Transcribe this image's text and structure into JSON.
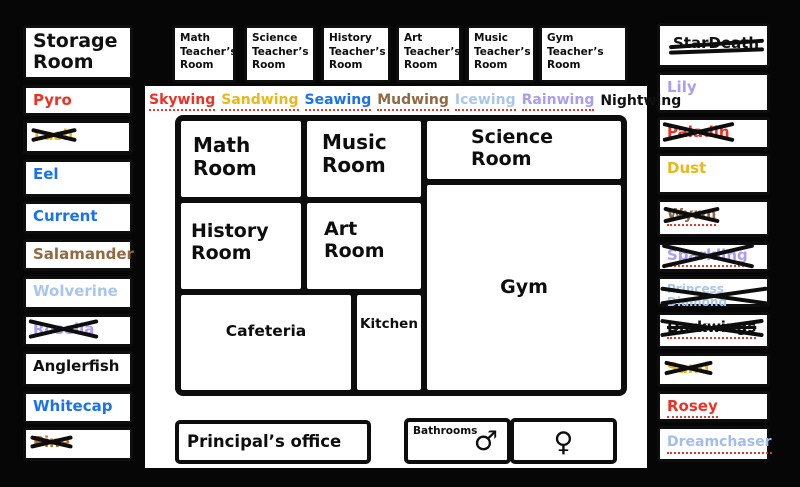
{
  "colors": {
    "skywing_red": "#ed3124",
    "sandwing_gold": "#eab818",
    "seawing_blue": "#1b72ee",
    "mudwing_brown": "#8f6a43",
    "icewing_pale_blue": "#a8c6ee",
    "rainwing_lavender": "#a99df5",
    "nightwing_black": "#101010"
  },
  "left_column": {
    "items": [
      {
        "label": "Storage Room",
        "color": "#101010",
        "status": "active"
      },
      {
        "label": "Pyro",
        "color": "#ed3124",
        "status": "active"
      },
      {
        "label": "Lash",
        "color": "#eab818",
        "status": "crossed-out"
      },
      {
        "label": "Eel",
        "color": "#1b72ee",
        "status": "active"
      },
      {
        "label": "Current",
        "color": "#1b72ee",
        "status": "active"
      },
      {
        "label": "Salamander",
        "color": "#8f6a43",
        "status": "active"
      },
      {
        "label": "Wolverine",
        "color": "#a8c6ee",
        "status": "active"
      },
      {
        "label": "Rosella",
        "color": "#a99df5",
        "status": "crossed-out"
      },
      {
        "label": "Anglerfish",
        "color": "#101010",
        "status": "active"
      },
      {
        "label": "Whitecap",
        "color": "#1b72ee",
        "status": "active"
      },
      {
        "label": "Pine",
        "color": "#b4762e",
        "status": "crossed-out"
      }
    ]
  },
  "right_column": {
    "items": [
      {
        "label": "StarDeath",
        "color": "#101010",
        "status": "struck-through"
      },
      {
        "label": "Lily",
        "color": "#a99df5",
        "status": "active"
      },
      {
        "label": "Paladin",
        "color": "#ed3124",
        "status": "crossed-out"
      },
      {
        "label": "Dust",
        "color": "#eab818",
        "status": "active"
      },
      {
        "label": "Wyrm",
        "color": "#8f6a43",
        "status": "crossed-out"
      },
      {
        "label": "Sparkling",
        "color": "#a99df5",
        "status": "crossed-out"
      },
      {
        "label": "Princess Diamond",
        "color": "#a8c6ee",
        "status": "crossed-out"
      },
      {
        "label": "Darkwings",
        "color": "#101010",
        "status": "crossed-out"
      },
      {
        "label": "Sand",
        "color": "#eab818",
        "status": "crossed-out"
      },
      {
        "label": "Rosey",
        "color": "#ed3124",
        "status": "active"
      },
      {
        "label": "Dreamchaser",
        "color": "#a3bcf2",
        "status": "active"
      }
    ]
  },
  "teacher_rooms": {
    "items": [
      {
        "label": "Math Teacher’s Room"
      },
      {
        "label": "Science Teacher’s Room"
      },
      {
        "label": "History Teacher’s Room"
      },
      {
        "label": "Art Teacher’s Room"
      },
      {
        "label": "Music Teacher’s Room"
      },
      {
        "label": "Gym Teacher’s Room"
      }
    ]
  },
  "legend": {
    "tribes": [
      {
        "name": "Skywing",
        "color": "#ed3124"
      },
      {
        "name": "Sandwing",
        "color": "#eab818"
      },
      {
        "name": "Seawing",
        "color": "#1b72ee"
      },
      {
        "name": "Mudwing",
        "color": "#8f6a43"
      },
      {
        "name": "Icewing",
        "color": "#a8c6ee"
      },
      {
        "name": "Rainwing",
        "color": "#a99df5"
      },
      {
        "name": "Nightwing",
        "color": "#101010"
      }
    ]
  },
  "map": {
    "rooms": {
      "math": "Math Room",
      "music": "Music Room",
      "science": "Science Room",
      "history": "History Room",
      "art": "Art Room",
      "gym": "Gym",
      "cafeteria": "Cafeteria",
      "kitchen": "Kitchen"
    }
  },
  "bottom_row": {
    "principal_office": "Principal’s office",
    "bathrooms_label": "Bathrooms",
    "male_symbol": "♂",
    "female_symbol": "♀"
  }
}
